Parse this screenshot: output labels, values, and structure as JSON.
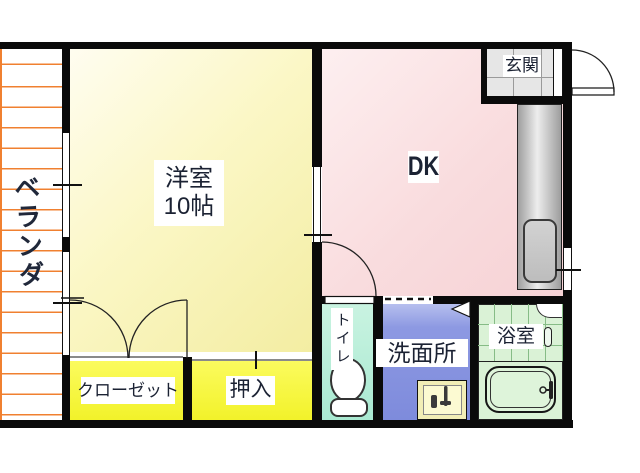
{
  "floorplan": {
    "title": "1DK apartment floor plan",
    "rooms": {
      "veranda": {
        "label": "ベランダ"
      },
      "western_room": {
        "label": "洋室",
        "size": "10帖"
      },
      "dk": {
        "label": "DK"
      },
      "entrance": {
        "label": "玄関"
      },
      "closet": {
        "label": "クローゼット"
      },
      "oshiire": {
        "label": "押入"
      },
      "toilet": {
        "label": "トイレ"
      },
      "washroom": {
        "label": "洗面所"
      },
      "bathroom": {
        "label": "浴室"
      }
    },
    "colors": {
      "wall": "#0a0a0a",
      "veranda_hatch": "#f08030",
      "western_room_fill": "#f7f2ae",
      "closet_fill": "#f6f63c",
      "dk_fill": "#f9dcde",
      "toilet_fill": "#b5eed9",
      "washroom_fill": "#8490de",
      "bathroom_fill": "#d9f1d5",
      "entrance_fill": "#e6e6e6",
      "kitchen_fill": "#c9c9c9",
      "label_text": "#1b2233"
    },
    "fixtures": [
      "kitchen-counter-with-sink",
      "toilet-bowl",
      "washstand-with-faucets",
      "bathtub-with-faucet"
    ]
  }
}
